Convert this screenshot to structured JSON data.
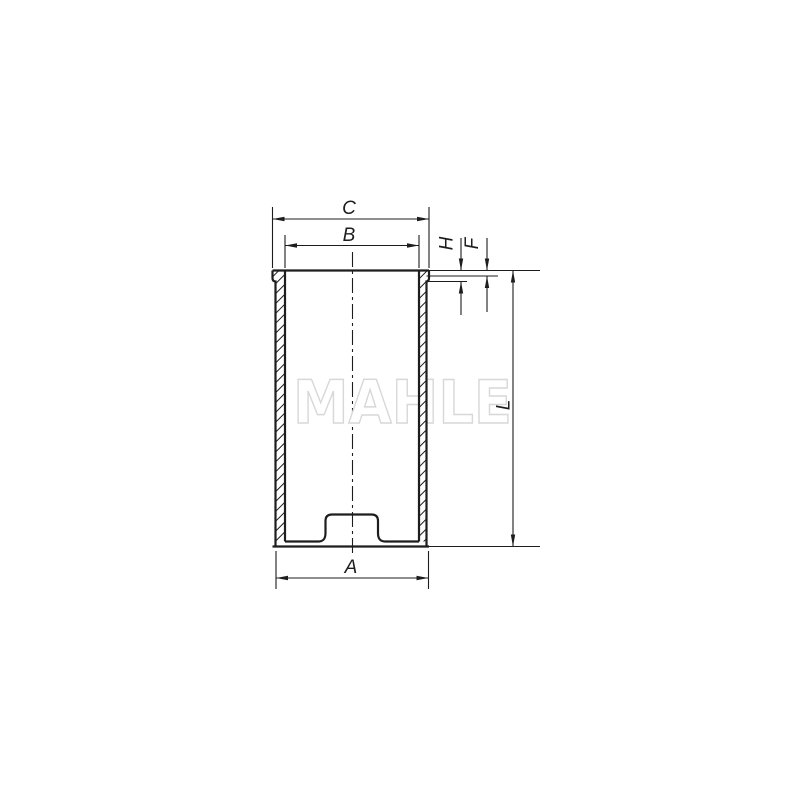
{
  "drawing": {
    "watermark_text": "MAHLE",
    "labels": {
      "c": "C",
      "b": "B",
      "h": "H",
      "f": "F",
      "l": "L",
      "a": "A"
    },
    "colors": {
      "line": "#1d1d1d",
      "watermark_outline": "#d8d8d8",
      "watermark_fill": "#ffffff",
      "background": "#ffffff"
    }
  }
}
